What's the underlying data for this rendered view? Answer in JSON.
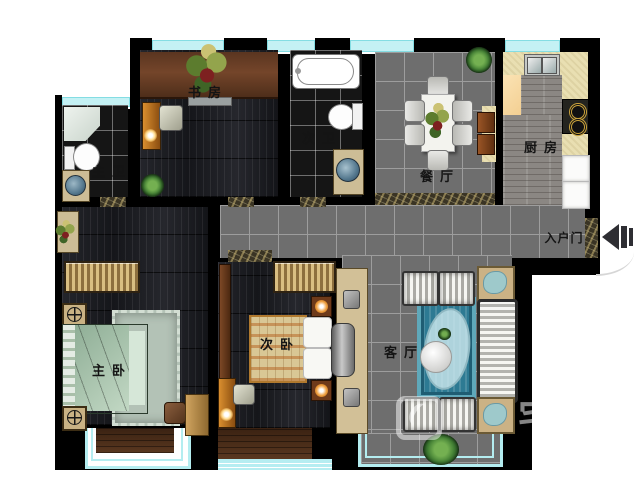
{
  "plan": {
    "type": "apartment-floor-plan",
    "rooms": {
      "study": {
        "label": "书房"
      },
      "master_bath": {
        "label": "主卫"
      },
      "second_bath": {
        "label": "次卫"
      },
      "dining": {
        "label": "餐厅"
      },
      "kitchen": {
        "label": "厨房"
      },
      "entry_door": {
        "label": "入户门"
      },
      "master_bedroom": {
        "label": "主卧"
      },
      "second_bedroom": {
        "label": "次卧"
      },
      "living": {
        "label": "客厅"
      }
    },
    "icons": {
      "entry_arrow": "left-arrow-into-apartment",
      "plants": "potted-plant",
      "lamps": "glowing-lamp",
      "nightstand_dial": "circle-cross-lamp"
    },
    "colors": {
      "wall": "#000000",
      "window_glass": "#b5edf1",
      "tile_gray": "#6e6e6e",
      "tile_black": "#151515",
      "wood_dark": "#1d1e22",
      "wood_bay": "#4a2e1b",
      "kitchen_counter": "#e9dfb2",
      "bed_green": "#a7c5ab",
      "rug_blue": "#2d7a93",
      "accent_orange": "#d98e2f"
    },
    "watermark": {
      "text": "宅配"
    }
  }
}
